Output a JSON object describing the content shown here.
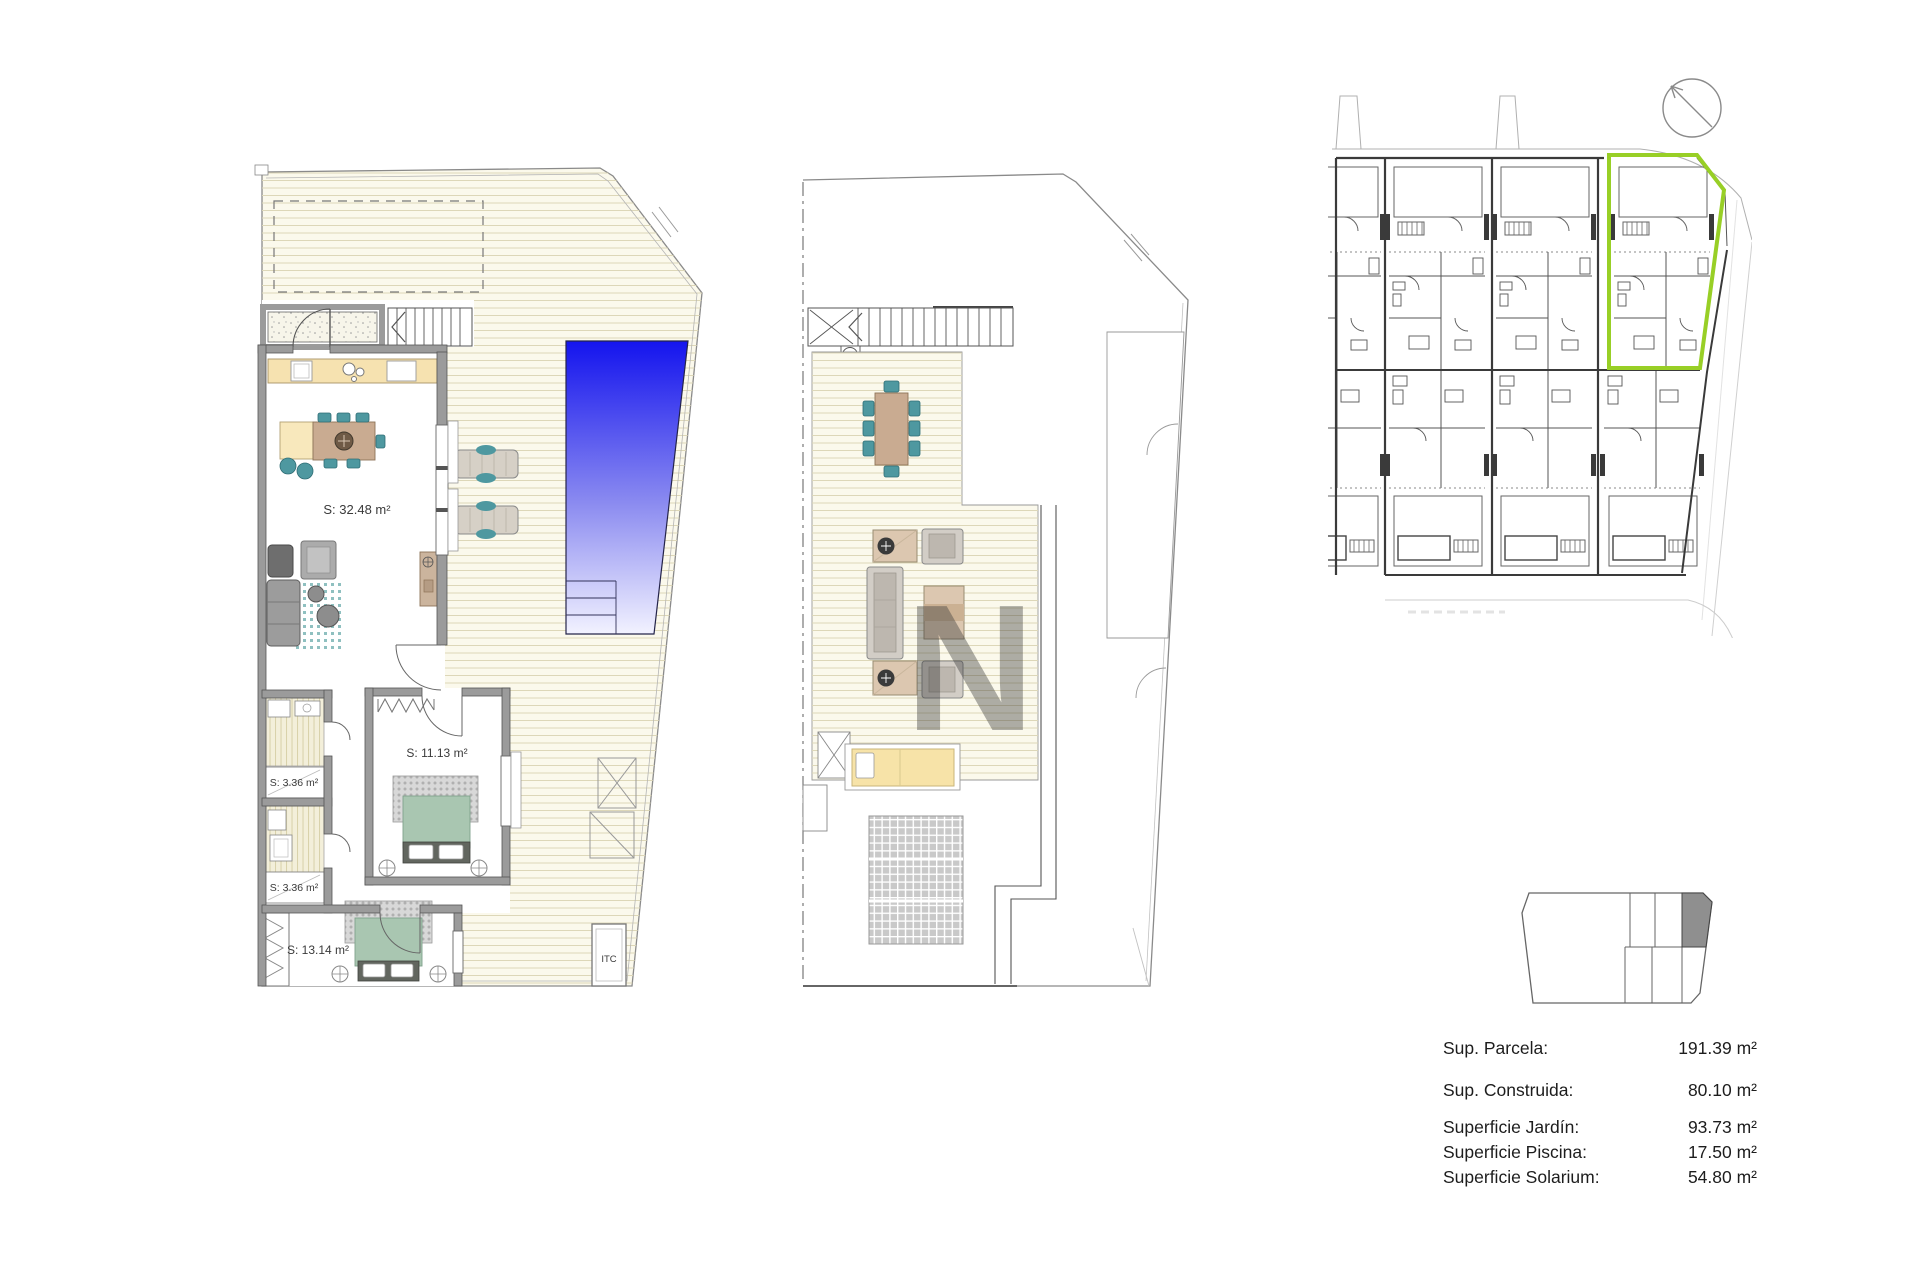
{
  "plans": {
    "ground_floor": {
      "rooms": [
        {
          "id": "living-kitchen",
          "label": "S: 32.48 m²"
        },
        {
          "id": "bedroom-1",
          "label": "S: 11.13 m²"
        },
        {
          "id": "bathroom-1",
          "label": "S: 3.36 m²"
        },
        {
          "id": "bathroom-2",
          "label": "S: 3.36 m²"
        },
        {
          "id": "bedroom-2",
          "label": "S: 13.14 m²"
        },
        {
          "id": "itc-closet",
          "label": "ITC"
        }
      ]
    },
    "solarium": {},
    "site_plan": {
      "highlighted_unit_outline": "#98cf26"
    }
  },
  "summary": {
    "rows": [
      {
        "label": "Sup. Parcela:",
        "value": "191.39 m²"
      },
      {
        "label": "Sup. Construida:",
        "value": "80.10 m²"
      },
      {
        "label": "Superficie Jardín:",
        "value": "93.73 m²"
      },
      {
        "label": "Superficie Piscina:",
        "value": "17.50 m²"
      },
      {
        "label": "Superficie Solarium:",
        "value": "54.80 m²"
      }
    ]
  },
  "colors": {
    "pool_top": "#1414ee",
    "pool_bottom": "#f2f2ff",
    "deck": "#fbf9ec",
    "deck_line": "#ddd7b8",
    "accent_teal": "#4e98a0",
    "furniture_tan": "#c9ab91",
    "kitchen_tan": "#f6e2b0",
    "bed_sage": "#a9c6b1",
    "daybed_yellow": "#f7e3a8",
    "highlight_green": "#98cf26",
    "wall_gray": "#9b9b9b",
    "key_unit_gray": "#8f8f8f"
  }
}
